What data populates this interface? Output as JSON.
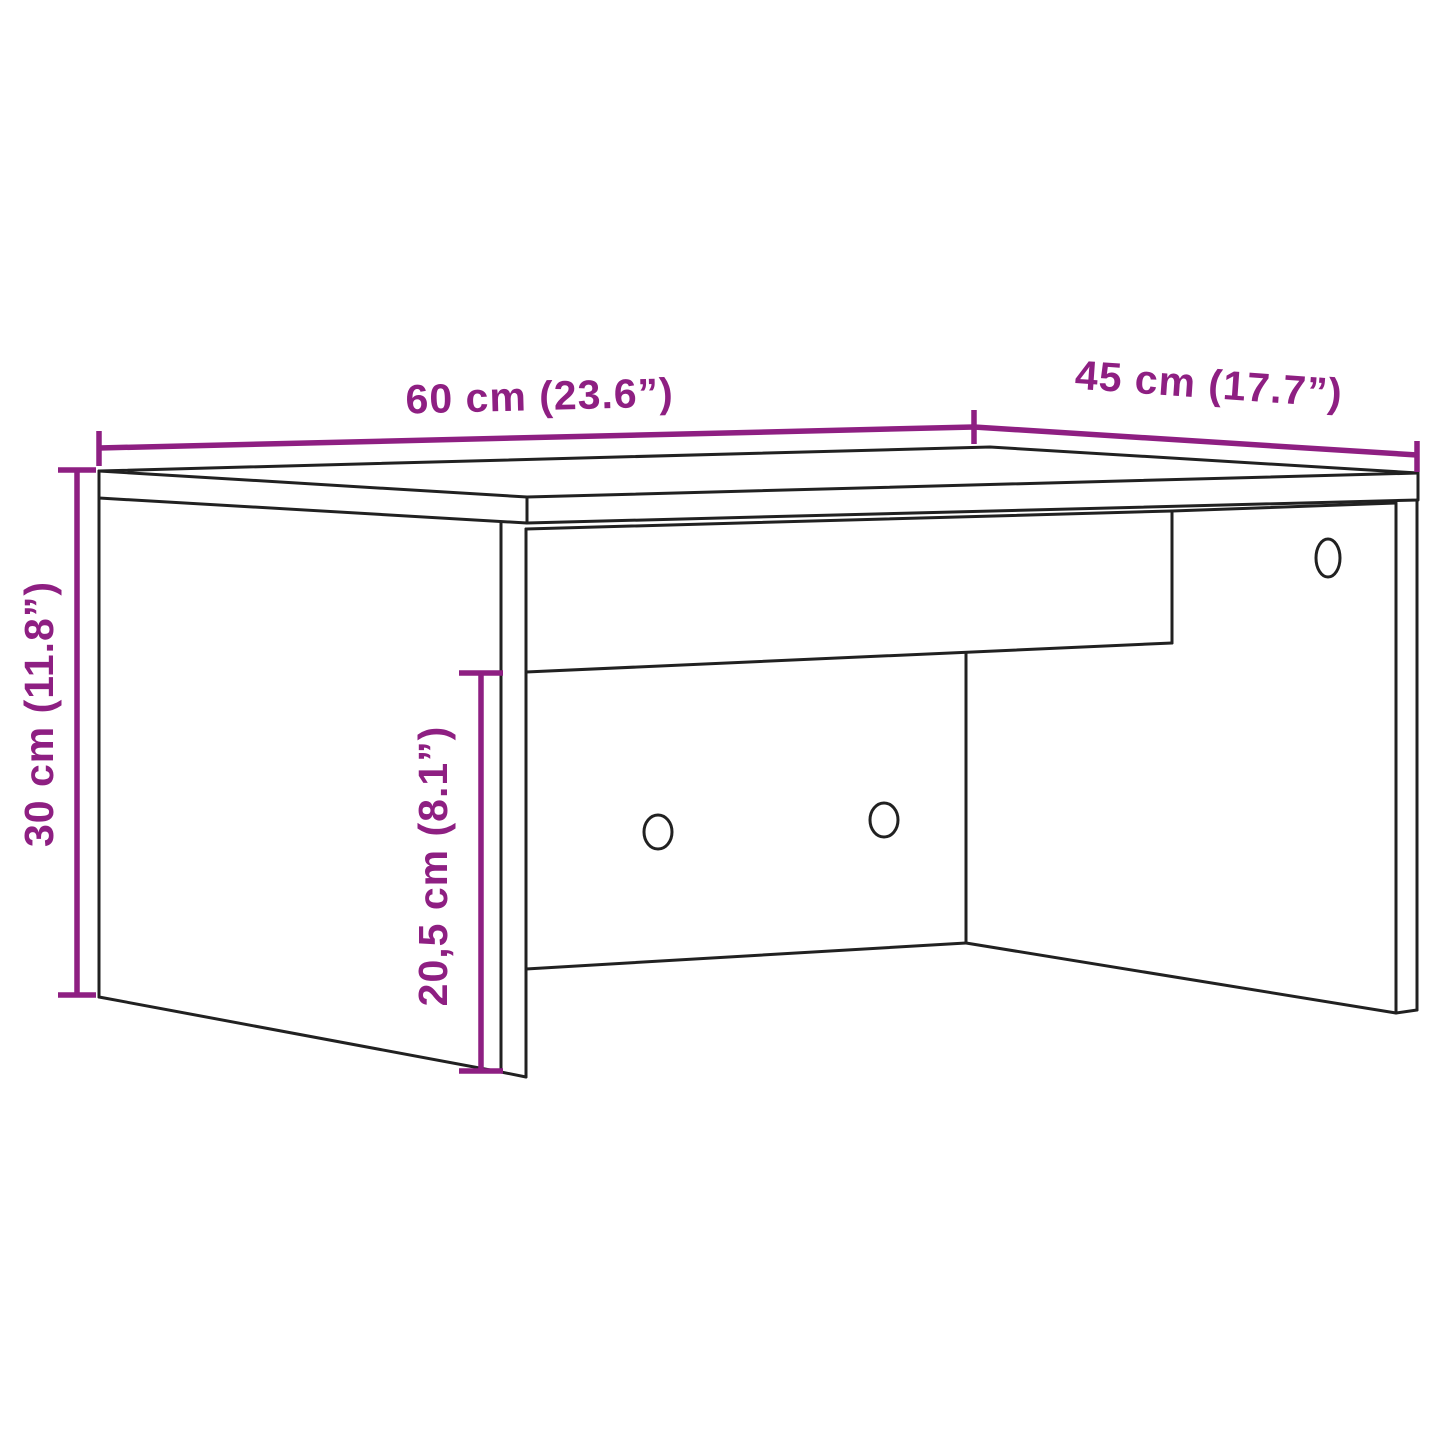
{
  "diagram": {
    "type": "furniture-dimension-line-drawing",
    "background_color": "#ffffff",
    "line_color": "#212121",
    "accent_color": "#8e1f82",
    "dimensions": {
      "width": {
        "label": "60 cm (23.6”)",
        "cm": "60",
        "inches": "23.6"
      },
      "depth": {
        "label": "45 cm (17.7”)",
        "cm": "45",
        "inches": "17.7"
      },
      "height": {
        "label": "30 cm (11.8”)",
        "cm": "30",
        "inches": "11.8"
      },
      "inner_height": {
        "label": "20,5 cm (8.1”)",
        "cm": "20,5",
        "inches": "8.1"
      }
    },
    "features": {
      "back_panel_hole_count": 2,
      "side_panel_hole_count": 1
    }
  }
}
